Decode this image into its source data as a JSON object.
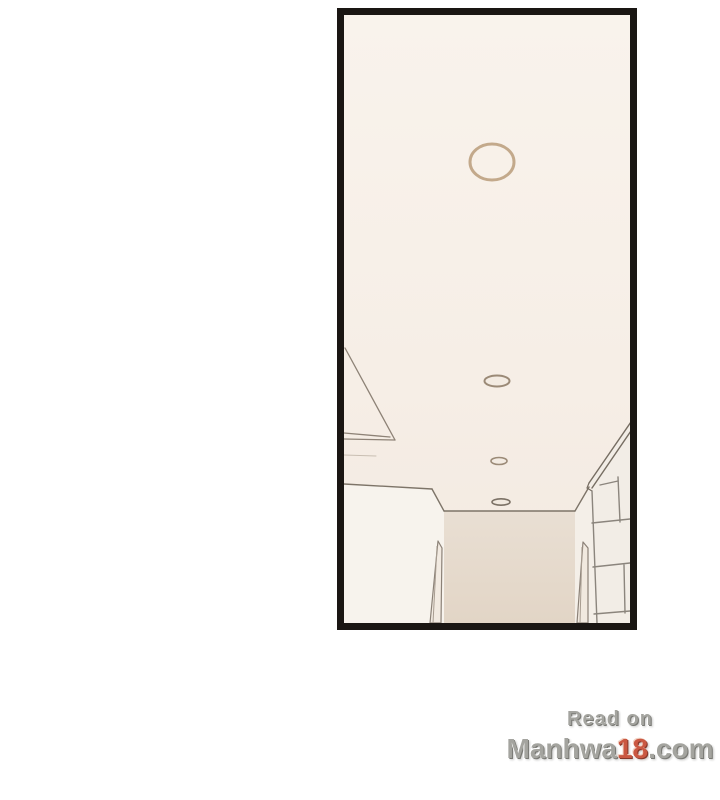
{
  "panel": {
    "kind": "manhwa-panel",
    "scene_description": "upward perspective view of a cream hallway ceiling with four round recessed lights, converging wall edges, door frames below and a white tiled wall on the right",
    "colors": {
      "border": "#1a1613",
      "ceiling_top": "#f9f3ec",
      "ceiling_bottom": "#f2e9e0",
      "left_wall": "#f7f3ed",
      "hall_wall_top": "#e9dfd3",
      "hall_wall_bottom": "#e2d5c6",
      "right_strip": "#f4efe8",
      "tile_wall": "#f2ede6",
      "line": "#867c71",
      "grout": "#8b857d",
      "light_ring_large": "#c3a98b",
      "light_ring_small": "#9b8a77"
    },
    "lights": [
      {
        "cx": 148,
        "cy": 147,
        "rx": 22,
        "ry": 18,
        "stroke": "#c3a98b",
        "stroke_width": 3,
        "fill": "#f8f1e9"
      },
      {
        "cx": 153,
        "cy": 366,
        "rx": 12.5,
        "ry": 5.5,
        "stroke": "#9b8a77",
        "stroke_width": 2,
        "fill": "#f3ebe2"
      },
      {
        "cx": 155,
        "cy": 446,
        "rx": 8,
        "ry": 3.5,
        "stroke": "#9b8a77",
        "stroke_width": 1.6,
        "fill": "#f3ebe2"
      },
      {
        "cx": 157,
        "cy": 487,
        "rx": 9,
        "ry": 3.2,
        "stroke": "#7c7266",
        "stroke_width": 1.6,
        "fill": "#f1e9df"
      }
    ]
  },
  "watermark": {
    "line1": "Read on",
    "line2_prefix": "Manhwa",
    "line2_highlight": "18",
    "line2_suffix": ".com",
    "text_color": "#9d9d97",
    "highlight_color": "#c64a32"
  }
}
